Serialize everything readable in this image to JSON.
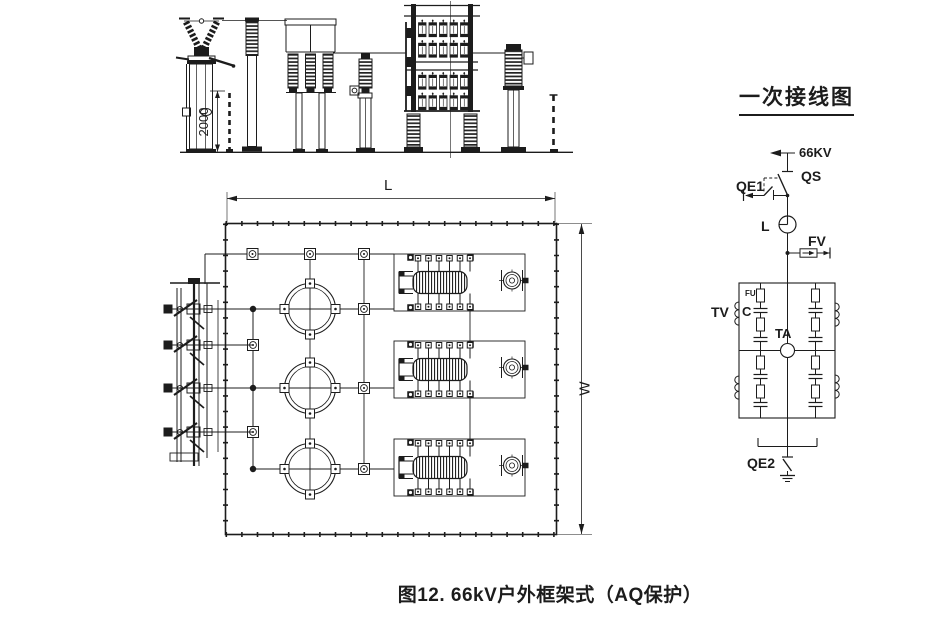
{
  "colors": {
    "ink": "#1c1c1c",
    "background": "#ffffff"
  },
  "caption": "图12. 66kV户外框架式（AQ保护）",
  "elevation": {
    "height_dim": "2000"
  },
  "plan": {
    "length_dim": "L",
    "width_dim": "W"
  },
  "schematic": {
    "title": "一次接线图",
    "labels": {
      "voltage": "66KV",
      "disconnector": "QS",
      "earth_switch_1": "QE1",
      "reactor": "L",
      "arrester": "FV",
      "voltage_transformer": "TV",
      "fuse": "FU",
      "capacitor": "C",
      "current_transformer": "TA",
      "earth_switch_2": "QE2"
    }
  }
}
